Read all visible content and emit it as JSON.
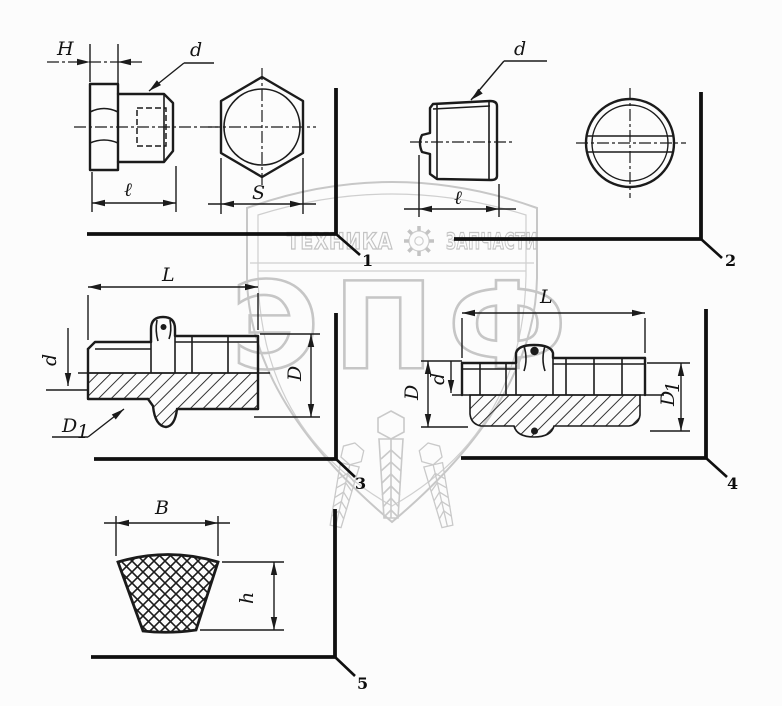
{
  "colors": {
    "line": "#1b1b1b",
    "watermark": "#c6c6c6",
    "background": "#fcfcfc"
  },
  "watermark": {
    "banner_left": "ТЕХНИКА",
    "banner_right": "ЗАПЧАСТИ",
    "gear_icon": "gear",
    "logo": "ЭПФ"
  },
  "figures": {
    "fig1": {
      "callout": "1",
      "labels": {
        "head_height": "Н",
        "diameter": "d",
        "length": "ℓ",
        "across_flats": "S"
      }
    },
    "fig2": {
      "callout": "2",
      "labels": {
        "diameter": "d",
        "length": "ℓ"
      }
    },
    "fig3": {
      "callout": "3",
      "labels": {
        "length": "L",
        "thread_diameter": "d",
        "outer_diameter": "D",
        "flange_base": "D",
        "flange_sub": "1"
      }
    },
    "fig4": {
      "callout": "4",
      "labels": {
        "length": "L",
        "outer_diameter": "D",
        "thread_diameter": "d",
        "flange_base": "D",
        "flange_sub": "1"
      }
    },
    "fig5": {
      "callout": "5",
      "labels": {
        "width": "В",
        "height": "h"
      }
    }
  }
}
